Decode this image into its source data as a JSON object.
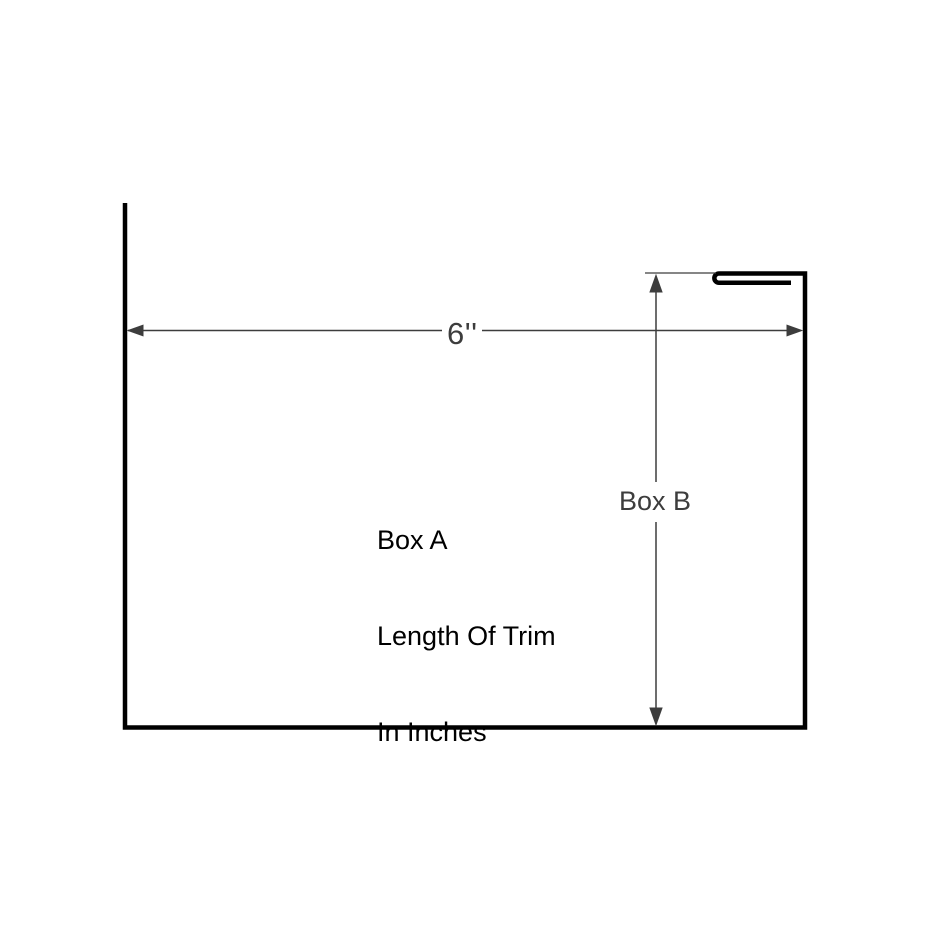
{
  "diagram": {
    "type": "trim-profile-dimension-drawing",
    "background": "#ffffff",
    "colors": {
      "outline": "#000000",
      "dimension": "#3d3d3d",
      "box_a_text": "#000000",
      "box_b_text": "#3d3d3d"
    },
    "width_dimension": {
      "label": "6''",
      "orientation": "horizontal"
    },
    "height_dimension": {
      "label": "Box B",
      "orientation": "vertical"
    },
    "box_a": {
      "lines": [
        "Box A",
        "Length Of Trim",
        "In Inches"
      ]
    }
  }
}
